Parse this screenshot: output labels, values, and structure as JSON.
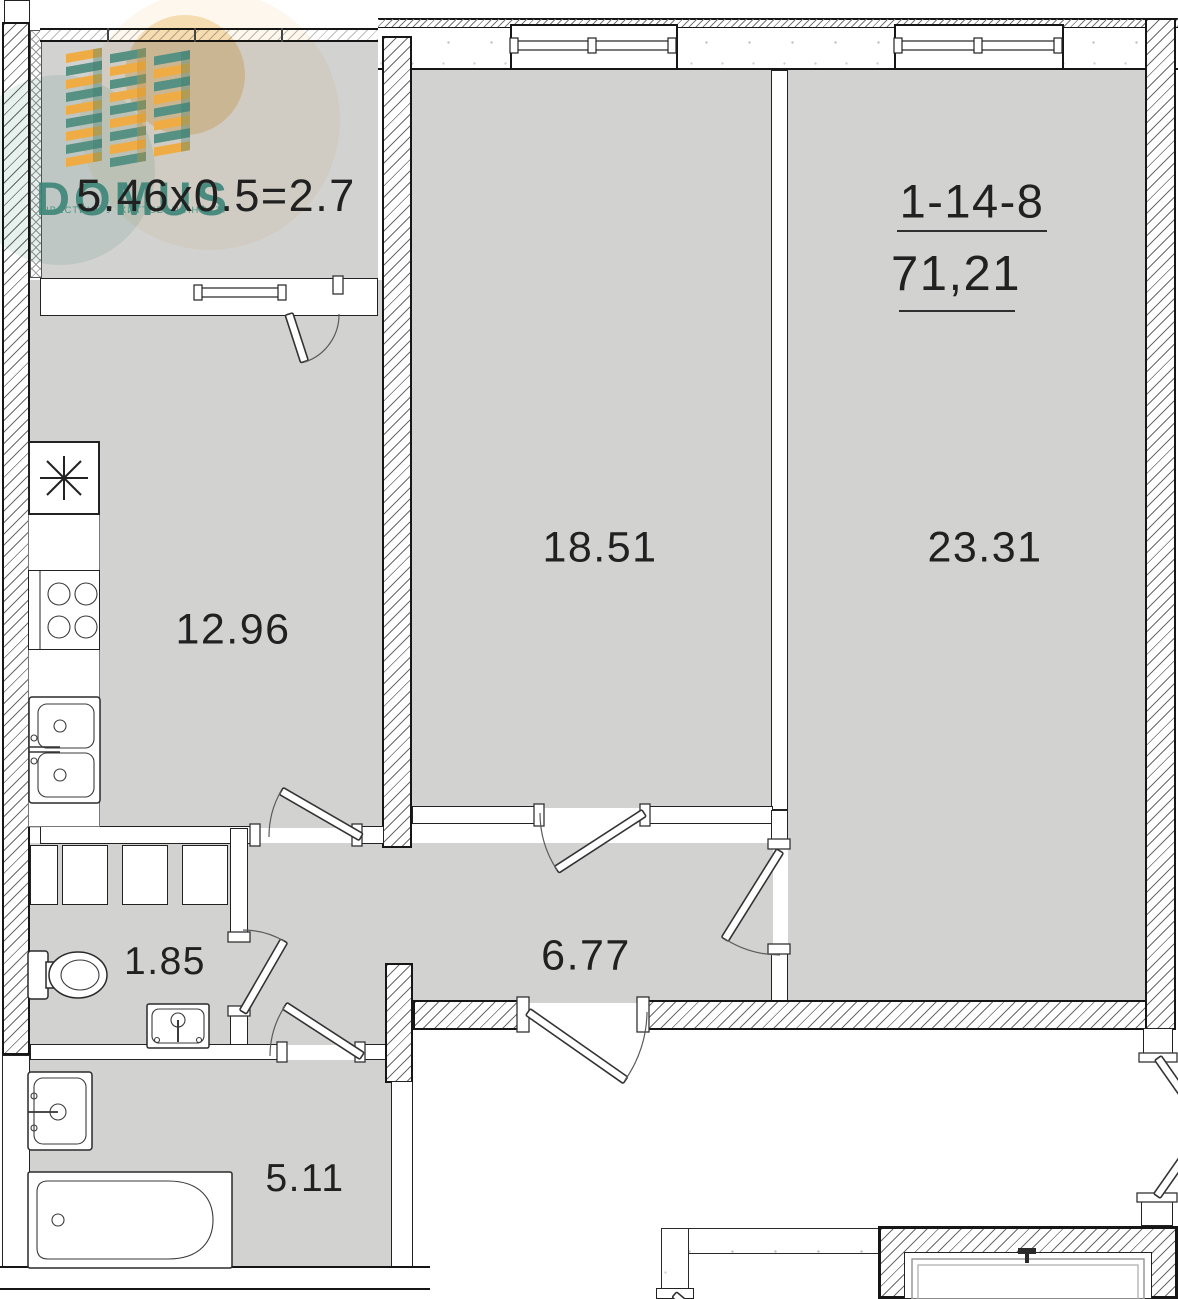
{
  "logo": {
    "name": "DOMUS",
    "tagline": "ІНВЕСТИЦІЇ У ЖИТТЄВІ ЦІННОСТІ",
    "teal": "#3d8578",
    "orange": "#efac44"
  },
  "apartment": {
    "number": "1-14-8",
    "area": "71,21"
  },
  "rooms": {
    "balcony": {
      "label": "5.46x0.5=2.7"
    },
    "living": {
      "label": "18.51"
    },
    "bedroom": {
      "label": "23.31"
    },
    "kitchen": {
      "label": "12.96"
    },
    "hall": {
      "label": "6.77"
    },
    "wc": {
      "label": "1.85"
    },
    "bath": {
      "label": "5.11"
    }
  },
  "colors": {
    "room_fill": "#d2d3d1",
    "line": "#161616",
    "watermark_peach": "#f6dcae",
    "watermark_teal": "#8ec0b2"
  }
}
